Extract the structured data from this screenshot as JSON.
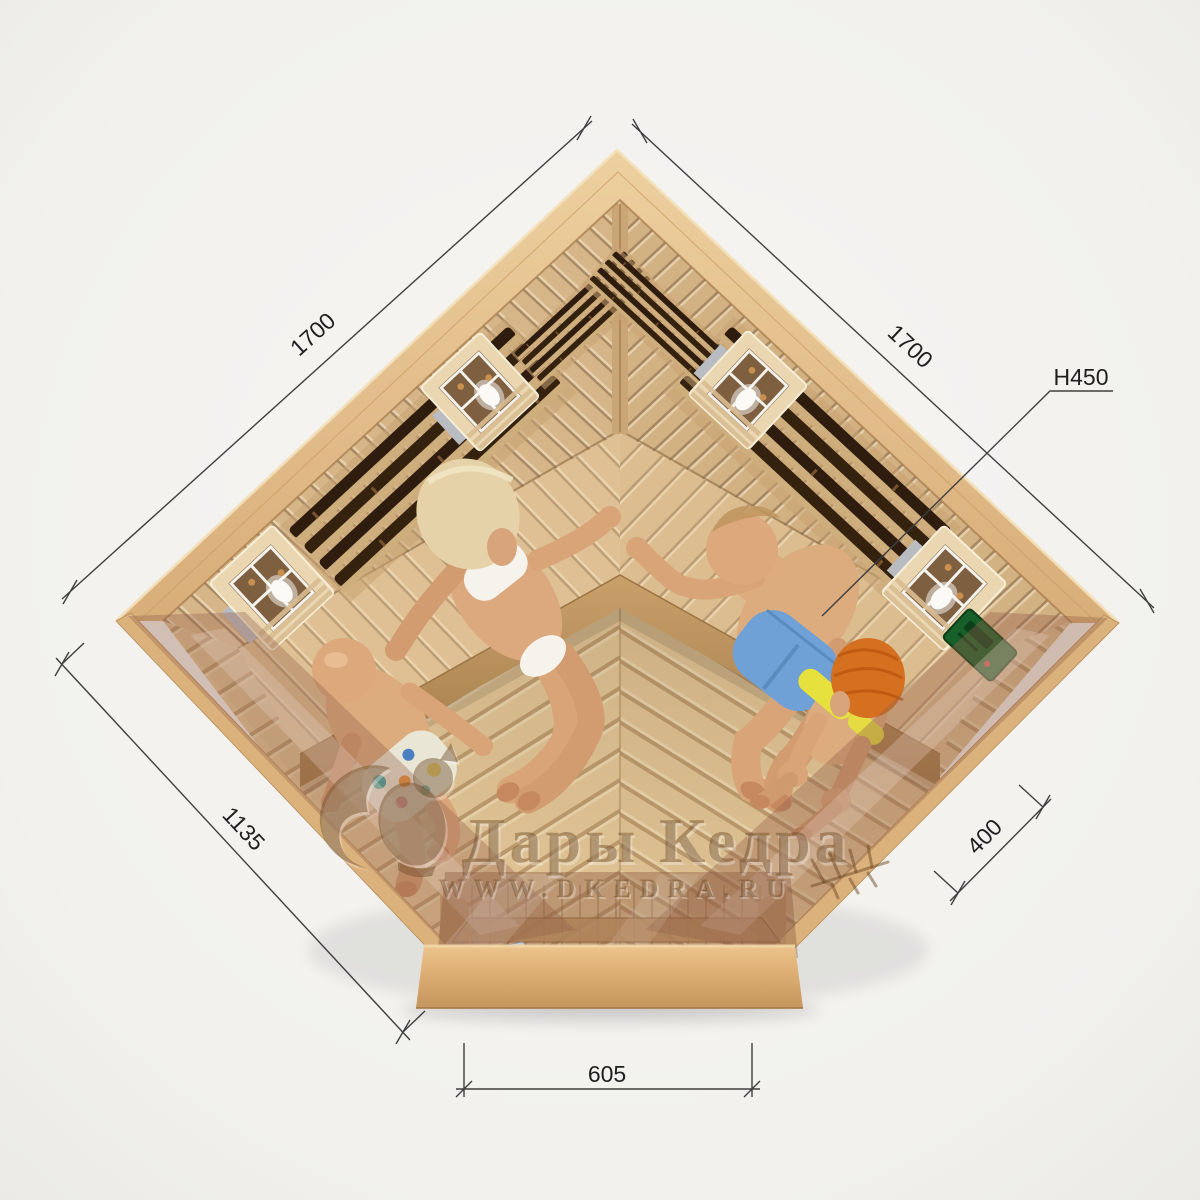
{
  "page": {
    "width": 1200,
    "height": 1200,
    "background": "#f2f1ee"
  },
  "annotations": {
    "dim_wall_left": "1700",
    "dim_wall_right": "1700",
    "dim_height": "H450",
    "dim_front_left": "1135",
    "dim_side_right": "400",
    "dim_door_width": "605"
  },
  "watermark": {
    "brand": "Дары Кедра",
    "website": "WWW.DKEDRA.RU"
  },
  "scene": {
    "description": "Top view 3D render of a corner infrared sauna cabin with four occupants, glass front and door, wall heater grilles, two lamps per wall and a green control panel",
    "occupant_count": 4,
    "colors": {
      "wood_light": "#ecd2a2",
      "wood_mid": "#dcb584",
      "wood_dark": "#a87f4e",
      "heater_dark": "#2e1d0e",
      "glass_tint": "rgba(150,98,74,0.40)",
      "dimension_line": "#3f3f3f",
      "watermark_brown": "rgba(110,75,38,0.45)",
      "shorts_blue": "#6fa0d6",
      "bikini_white": "#f6f3ec",
      "bikini_yellow": "#e6e13d",
      "hair_blonde": "#e5d2a8",
      "hair_orange": "#d4701f",
      "control_green": "#17602a"
    }
  }
}
